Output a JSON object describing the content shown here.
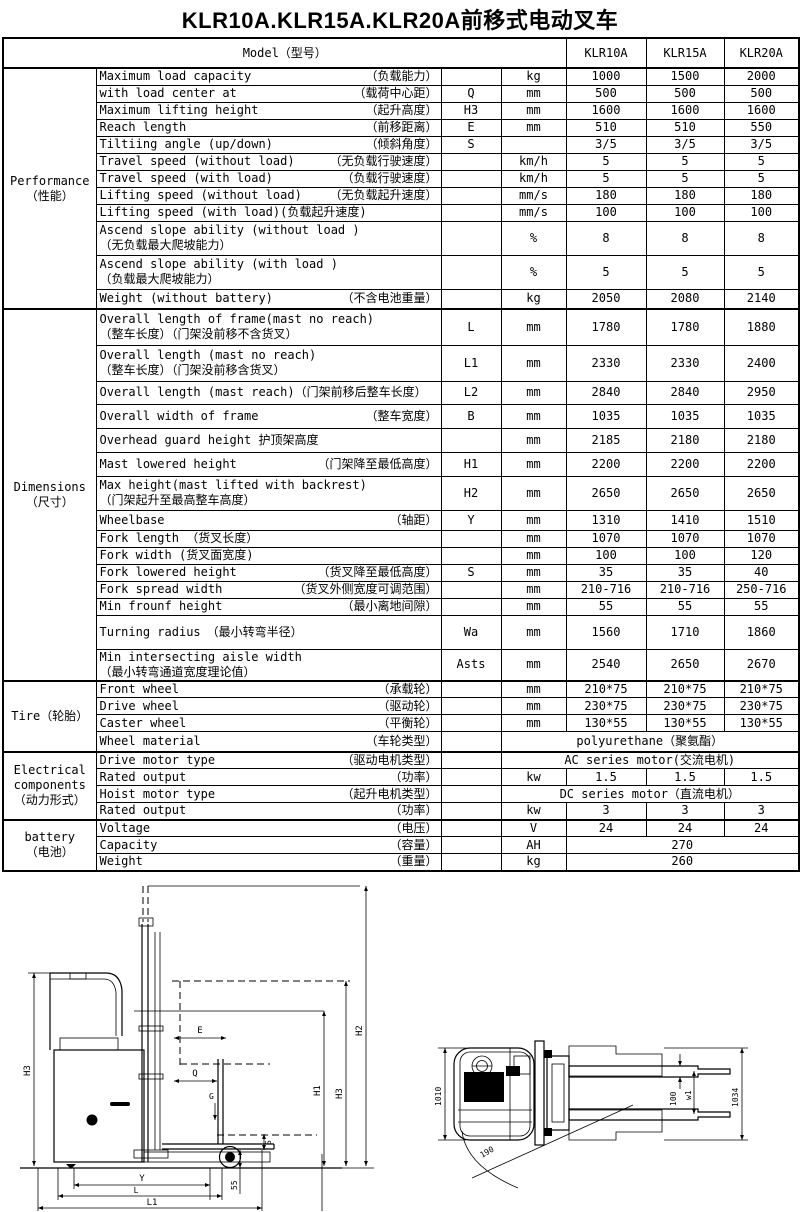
{
  "title": "KLR10A.KLR15A.KLR20A前移式电动叉车",
  "header": {
    "model_label": "Model（型号）",
    "models": [
      "KLR10A",
      "KLR15A",
      "KLR20A"
    ]
  },
  "sections": [
    {
      "label_lines": [
        "Performance",
        "（性能）"
      ],
      "rows": [
        {
          "layout": "justify",
          "en": "Maximum load capacity",
          "cn": "（负载能力）",
          "sym": "",
          "unit": "kg",
          "values": [
            "1000",
            "1500",
            "2000"
          ]
        },
        {
          "layout": "justify",
          "en": "with load center at",
          "cn": "（载荷中心距）",
          "sym": "Q",
          "unit": "mm",
          "values": [
            "500",
            "500",
            "500"
          ]
        },
        {
          "layout": "justify",
          "en": "Maximum lifting height",
          "cn": "（起升高度）",
          "sym": "H3",
          "unit": "mm",
          "values": [
            "1600",
            "1600",
            "1600"
          ]
        },
        {
          "layout": "justify",
          "en": "Reach length",
          "cn": "（前移距离）",
          "sym": "E",
          "unit": "mm",
          "values": [
            "510",
            "510",
            "550"
          ]
        },
        {
          "layout": "justify",
          "en": "Tiltiing angle (up/down)",
          "cn": "（倾斜角度）",
          "sym": "S",
          "unit": "",
          "values": [
            "3/5",
            "3/5",
            "3/5"
          ]
        },
        {
          "layout": "justify",
          "en": "Travel speed (without load)",
          "cn": "（无负载行驶速度）",
          "sym": "",
          "unit": "km/h",
          "values": [
            "5",
            "5",
            "5"
          ]
        },
        {
          "layout": "justify",
          "en": "Travel speed (with load)",
          "cn": "（负载行驶速度）",
          "sym": "",
          "unit": "km/h",
          "values": [
            "5",
            "5",
            "5"
          ]
        },
        {
          "layout": "justify",
          "en": "Lifting speed (without load)",
          "cn": "（无负载起升速度）",
          "sym": "",
          "unit": "mm/s",
          "values": [
            "180",
            "180",
            "180"
          ]
        },
        {
          "layout": "inline",
          "en": "Lifting speed (with load)(负载起升速度)",
          "cn": "",
          "sym": "",
          "unit": "mm/s",
          "values": [
            "100",
            "100",
            "100"
          ]
        },
        {
          "layout": "stack",
          "en": "Ascend slope ability (without load )",
          "cn": "（无负载最大爬坡能力）",
          "sym": "",
          "unit": "%",
          "values": [
            "8",
            "8",
            "8"
          ]
        },
        {
          "layout": "stack",
          "en": "Ascend slope ability (with load )",
          "cn": "（负载最大爬坡能力）",
          "sym": "",
          "unit": "%",
          "values": [
            "5",
            "5",
            "5"
          ]
        },
        {
          "layout": "justify",
          "en": "Weight (without battery)",
          "cn": "（不含电池重量）",
          "sym": "",
          "unit": "kg",
          "values": [
            "2050",
            "2080",
            "2140"
          ]
        }
      ]
    },
    {
      "label_lines": [
        "Dimensions",
        "（尺寸）"
      ],
      "rows": [
        {
          "layout": "stack",
          "en": "Overall length of frame(mast no reach)",
          "cn": "（整车长度）（门架没前移不含货叉）",
          "sym": "L",
          "unit": "mm",
          "values": [
            "1780",
            "1780",
            "1880"
          ]
        },
        {
          "layout": "stack",
          "en": "Overall length (mast no reach)",
          "cn": "（整车长度）（门架没前移含货叉）",
          "sym": "L1",
          "unit": "mm",
          "values": [
            "2330",
            "2330",
            "2400"
          ]
        },
        {
          "layout": "inline",
          "en": "Overall length (mast reach)（门架前移后整车长度）",
          "cn": "",
          "sym": "L2",
          "unit": "mm",
          "values": [
            "2840",
            "2840",
            "2950"
          ]
        },
        {
          "layout": "justify",
          "en": "Overall width of frame",
          "cn": "（整车宽度）",
          "sym": "B",
          "unit": "mm",
          "values": [
            "1035",
            "1035",
            "1035"
          ]
        },
        {
          "layout": "inline",
          "en": "Overhead guard height 护顶架高度",
          "cn": "",
          "sym": "",
          "unit": "mm",
          "values": [
            "2185",
            "2180",
            "2180"
          ]
        },
        {
          "layout": "justify",
          "en": "Mast lowered height",
          "cn": "（门架降至最低高度）",
          "sym": "H1",
          "unit": "mm",
          "values": [
            "2200",
            "2200",
            "2200"
          ]
        },
        {
          "layout": "stack",
          "en": "Max height(mast lifted with backrest)",
          "cn": "（门架起升至最高整车高度）",
          "sym": "H2",
          "unit": "mm",
          "values": [
            "2650",
            "2650",
            "2650"
          ]
        },
        {
          "layout": "justify",
          "en": "Wheelbase",
          "cn": "（轴距）",
          "sym": "Y",
          "unit": "mm",
          "values": [
            "1310",
            "1410",
            "1510"
          ]
        },
        {
          "layout": "inline",
          "en": "Fork length （货叉长度）",
          "cn": "",
          "sym": "",
          "unit": "mm",
          "values": [
            "1070",
            "1070",
            "1070"
          ]
        },
        {
          "layout": "inline",
          "en": "Fork width (货叉面宽度)",
          "cn": "",
          "sym": "",
          "unit": "mm",
          "values": [
            "100",
            "100",
            "120"
          ]
        },
        {
          "layout": "justify",
          "en": "Fork lowered height",
          "cn": "（货叉降至最低高度）",
          "sym": "S",
          "unit": "mm",
          "values": [
            "35",
            "35",
            "40"
          ]
        },
        {
          "layout": "justify",
          "en": "Fork spread width",
          "cn": "（货叉外侧宽度可调范围）",
          "sym": "",
          "unit": "mm",
          "values": [
            "210-716",
            "210-716",
            "250-716"
          ]
        },
        {
          "layout": "justify",
          "en": "Min frounf height",
          "cn": "（最小离地间隙）",
          "sym": "",
          "unit": "mm",
          "values": [
            "55",
            "55",
            "55"
          ]
        },
        {
          "layout": "inline",
          "en": "Turning radius　（最小转弯半径）",
          "cn": "",
          "sym": "Wa",
          "unit": "mm",
          "values": [
            "1560",
            "1710",
            "1860"
          ]
        },
        {
          "layout": "stack",
          "en": "Min intersecting aisle width",
          "cn": "（最小转弯通道宽度理论值）",
          "sym": "Asts",
          "unit": "mm",
          "values": [
            "2540",
            "2650",
            "2670"
          ]
        }
      ]
    },
    {
      "label_lines": [
        "Tire（轮胎）"
      ],
      "rows": [
        {
          "layout": "justify",
          "en": "Front wheel",
          "cn": "（承载轮）",
          "sym": "",
          "unit": "mm",
          "values": [
            "210*75",
            "210*75",
            "210*75"
          ]
        },
        {
          "layout": "justify",
          "en": "Drive wheel",
          "cn": "（驱动轮）",
          "sym": "",
          "unit": "mm",
          "values": [
            "230*75",
            "230*75",
            "230*75"
          ]
        },
        {
          "layout": "justify",
          "en": "Caster wheel",
          "cn": "（平衡轮）",
          "sym": "",
          "unit": "mm",
          "values": [
            "130*55",
            "130*55",
            "130*55"
          ]
        },
        {
          "layout": "justify",
          "en": "Wheel material",
          "cn": "（车轮类型）",
          "span": "full",
          "value": "polyurethane（聚氨酯）"
        }
      ]
    },
    {
      "label_lines": [
        "Electrical",
        "components",
        "（动力形式）"
      ],
      "rows": [
        {
          "layout": "justify",
          "en": "Drive motor type",
          "cn": "（驱动电机类型）",
          "span": "full",
          "value": "AC series motor(交流电机)"
        },
        {
          "layout": "justify",
          "en": "Rated output",
          "cn": "（功率）",
          "sym": "",
          "unit": "kw",
          "values": [
            "1.5",
            "1.5",
            "1.5"
          ]
        },
        {
          "layout": "justify",
          "en": "Hoist motor type",
          "cn": "（起升电机类型）",
          "span": "full",
          "value": "DC series motor（直流电机）"
        },
        {
          "layout": "justify",
          "en": "Rated output",
          "cn": "（功率）",
          "sym": "",
          "unit": "kw",
          "values": [
            "3",
            "3",
            "3"
          ]
        }
      ]
    },
    {
      "label_lines": [
        "battery",
        "（电池）"
      ],
      "rows": [
        {
          "layout": "justify",
          "en": "Voltage",
          "cn": "（电压）",
          "sym": "",
          "unit": "V",
          "values": [
            "24",
            "24",
            "24"
          ]
        },
        {
          "layout": "justify",
          "en": "Capacity",
          "cn": "（容量）",
          "sym": "",
          "unit": "AH",
          "span": "models",
          "value": "270"
        },
        {
          "layout": "justify",
          "en": "Weight",
          "cn": "（重量）",
          "sym": "",
          "unit": "kg",
          "span": "models",
          "value": "260"
        }
      ]
    }
  ],
  "drawings": {
    "side_view": {
      "labels": {
        "h3_left": "H3",
        "e": "E",
        "q": "Q",
        "g": "G",
        "s": "S",
        "h1": "H1",
        "h3_right": "H3",
        "h2": "H2",
        "ground_clearance": "55",
        "y": "Y",
        "l": "L",
        "l1": "L1"
      }
    },
    "top_view": {
      "labels": {
        "overall_width": "1010",
        "fork_width": "100",
        "w1": "w1",
        "right_width": "1034",
        "steer_angle": "190"
      }
    }
  }
}
